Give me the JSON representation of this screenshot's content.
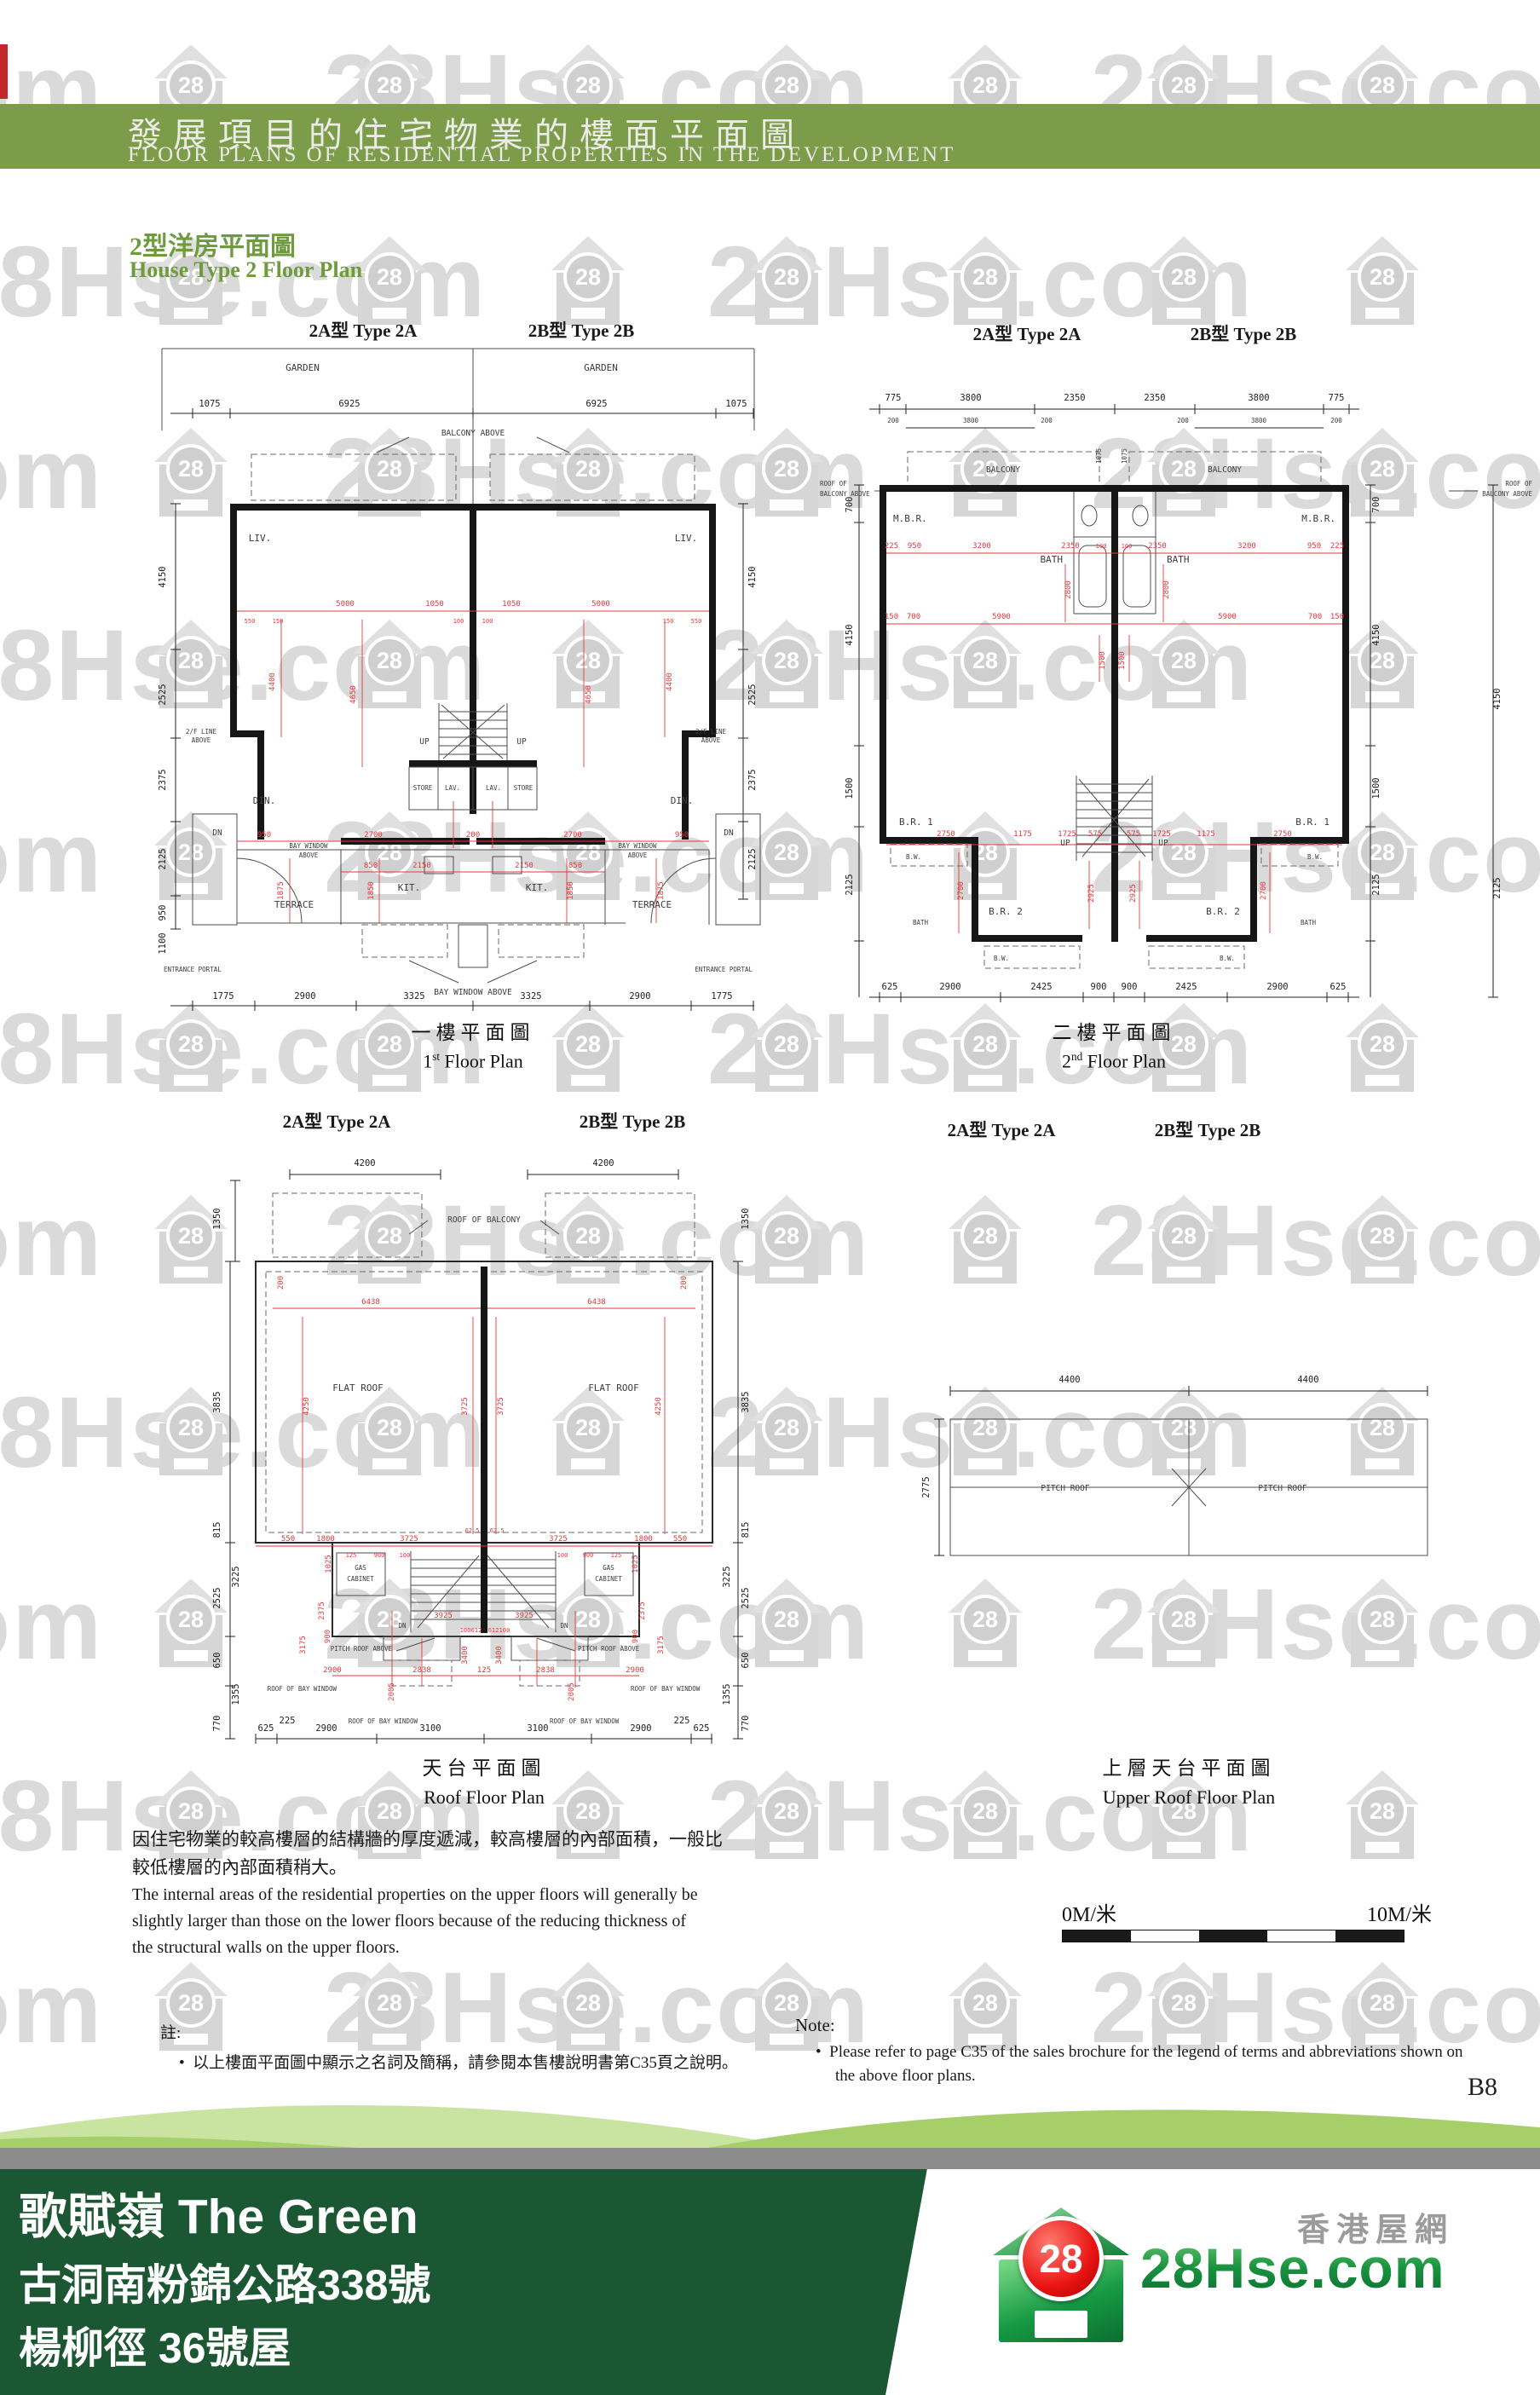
{
  "watermark": {
    "house_label": "28",
    "text": "28Hse.com"
  },
  "header": {
    "title_zh": "發展項目的住宅物業的樓面平面圖",
    "title_en": "FLOOR PLANS OF RESIDENTIAL PROPERTIES IN THE DEVELOPMENT"
  },
  "subtitle": {
    "zh": "2型洋房平面圖",
    "en": "House Type 2 Floor Plan"
  },
  "type_labels": {
    "a": "2A型 Type 2A",
    "b": "2B型 Type 2B"
  },
  "plans": {
    "first": {
      "caption_zh": "一樓平面圖",
      "caption_en_pre": "1",
      "caption_en_sup": "st",
      "caption_en_post": " Floor Plan",
      "garden": "GARDEN",
      "balcony_above": "BALCONY ABOVE",
      "bw1": "BAY WINDOW",
      "bw2": "ABOVE",
      "bay_window_above": "BAY WINDOW ABOVE",
      "liv": "LIV.",
      "din": "DIN.",
      "kit": "KIT.",
      "terrace": "TERRACE",
      "store": "STORE",
      "lav": "LAV.",
      "up": "UP",
      "dn": "DN",
      "fl_line1": "2/F LINE",
      "fl_line2": "ABOVE",
      "entrance": "ENTRANCE PORTAL",
      "top_dims": [
        "1075",
        "6925",
        "6925",
        "1075"
      ],
      "bottom_dims": [
        "1775",
        "2900",
        "3325",
        "3325",
        "2900",
        "1775"
      ],
      "left_dims": [
        "4150",
        "2525",
        "2375",
        "2125",
        "950",
        "1100"
      ],
      "right_dims": [
        "4150",
        "2525",
        "2375",
        "2125"
      ],
      "red_h1": [
        "5000",
        "1050",
        "1050",
        "5000"
      ],
      "red_small": [
        "550",
        "150",
        "100",
        "100",
        "150",
        "550"
      ],
      "red_v1": [
        "4400",
        "4650",
        "4650",
        "4400"
      ],
      "red_h2": [
        "950",
        "2700",
        "200",
        "2700",
        "950"
      ],
      "red_h3": [
        "850",
        "2150",
        "2150",
        "850"
      ],
      "red_v2": [
        "1875",
        "1850",
        "1850",
        "1875"
      ]
    },
    "second": {
      "caption_zh": "二樓平面圖",
      "caption_en_pre": "2",
      "caption_en_sup": "nd",
      "caption_en_post": " Floor Plan",
      "mbr": "M.B.R.",
      "bath": "BATH",
      "br1": "B.R. 1",
      "br2": "B.R. 2",
      "bw": "B.W.",
      "up": "UP",
      "balcony": "BALCONY",
      "roof_of": "ROOF OF",
      "balcony_above": "BALCONY ABOVE",
      "v1075": "1075",
      "top_dims": [
        "775",
        "3800",
        "2350",
        "2350",
        "3800",
        "775"
      ],
      "top_dims2": [
        "200",
        "3800",
        "200",
        "200",
        "3800",
        "200"
      ],
      "bottom_dims": [
        "625",
        "2900",
        "2425",
        "900",
        "900",
        "2425",
        "2900",
        "625"
      ],
      "left_dims": [
        "700",
        "4150",
        "1500",
        "2125"
      ],
      "right_dims": [
        "700",
        "4150",
        "1500",
        "2125"
      ],
      "red_h1": [
        "225",
        "950",
        "3200",
        "2350",
        "100",
        "100",
        "2350",
        "3200",
        "950",
        "225"
      ],
      "red_v1": [
        "2800",
        "2800",
        "1500",
        "1500"
      ],
      "red_h2": [
        "150",
        "700",
        "5900",
        "5900",
        "700",
        "150"
      ],
      "red_h3": [
        "2750",
        "1175",
        "1725",
        "575",
        "575",
        "1725",
        "1175",
        "2750"
      ],
      "red_v2": [
        "2700",
        "2925",
        "2925",
        "2700"
      ]
    },
    "roof": {
      "caption_zh": "天台平面圖",
      "caption_en": "Roof Floor Plan",
      "flat_roof": "FLAT ROOF",
      "roof_of_balcony": "ROOF OF BALCONY",
      "gas": "GAS",
      "cabinet": "CABINET",
      "dn": "DN",
      "pitch_roof_above": "PITCH ROOF ABOVE",
      "roof_of_bay": "ROOF OF BAY WINDOW",
      "top_dims": [
        "4200",
        "4200"
      ],
      "left_dims": [
        "1350",
        "3835",
        "815",
        "2525",
        "3225",
        "650",
        "1355",
        "770"
      ],
      "right_dims": [
        "1350",
        "3835",
        "815",
        "2525",
        "3225",
        "650",
        "1355",
        "770"
      ],
      "red_a": [
        "6438",
        "6438"
      ],
      "red_b": [
        "200",
        "200"
      ],
      "red_c": [
        "4250",
        "3725",
        "3725",
        "4250"
      ],
      "red_mid": [
        "550",
        "1800",
        "3725",
        "3725",
        "1800",
        "550"
      ],
      "red_mid_small": [
        "62.5",
        "62.5"
      ],
      "red_low": [
        "125",
        "900",
        "100",
        "100",
        "900",
        "125"
      ],
      "red_gas": [
        "1025",
        "2375",
        "900",
        "900",
        "2375",
        "1025"
      ],
      "red_stair": [
        "3925",
        "3925"
      ],
      "red_pitch": [
        "3400",
        "3175",
        "3175",
        "3400"
      ],
      "red_pitch_small": [
        "100",
        "612",
        "612",
        "100"
      ],
      "red_h2": [
        "2900",
        "2838",
        "125",
        "2838",
        "2900"
      ],
      "red_v2": [
        "2005",
        "2005"
      ],
      "small_225": [
        "225",
        "225"
      ],
      "bottom_dims": [
        "625",
        "2900",
        "3100",
        "3100",
        "2900",
        "625"
      ]
    },
    "upper": {
      "caption_zh": "上層天台平面圖",
      "caption_en": "Upper Roof Floor Plan",
      "pitch_roof": "PITCH ROOF",
      "top_dims": [
        "4400",
        "4400"
      ],
      "left_dim": "2775"
    }
  },
  "paragraph": {
    "zh1": "因住宅物業的較高樓層的結構牆的厚度遞減，較高樓層的內部面積，一般比",
    "zh2": "較低樓層的內部面積稍大。",
    "en1": "The internal areas of the residential properties on the upper floors will generally be",
    "en2": "slightly larger than those on the lower floors because of the reducing thickness of",
    "en3": "the structural walls on the upper floors."
  },
  "scalebar": {
    "left": "0M/米",
    "right": "10M/米"
  },
  "note_zh": {
    "heading": "註:",
    "bullet": "•",
    "item": "以上樓面平面圖中顯示之名詞及簡稱，請參閱本售樓說明書第C35頁之說明。"
  },
  "note_en": {
    "heading": "Note:",
    "bullet": "•",
    "item1": "Please refer to page C35 of the sales brochure for the legend of terms and abbreviations shown on",
    "item2": "the above floor plans."
  },
  "page_number": "B8",
  "footer": {
    "line1": "歌賦嶺 The Green",
    "line2": "古洞南粉錦公路338號",
    "line3": "楊柳徑 36號屋",
    "logo_28": "28",
    "logo_text": "28Hse.com",
    "logo_tagline": "香港屋網"
  },
  "colors": {
    "header_green": "#7d9c49",
    "footer_green": "#1c5733",
    "wave_light": "#c9e4a1",
    "wave_mid": "#a6cf6a",
    "band_gray": "#8c8c8c",
    "dim_red": "#e03a3e"
  }
}
